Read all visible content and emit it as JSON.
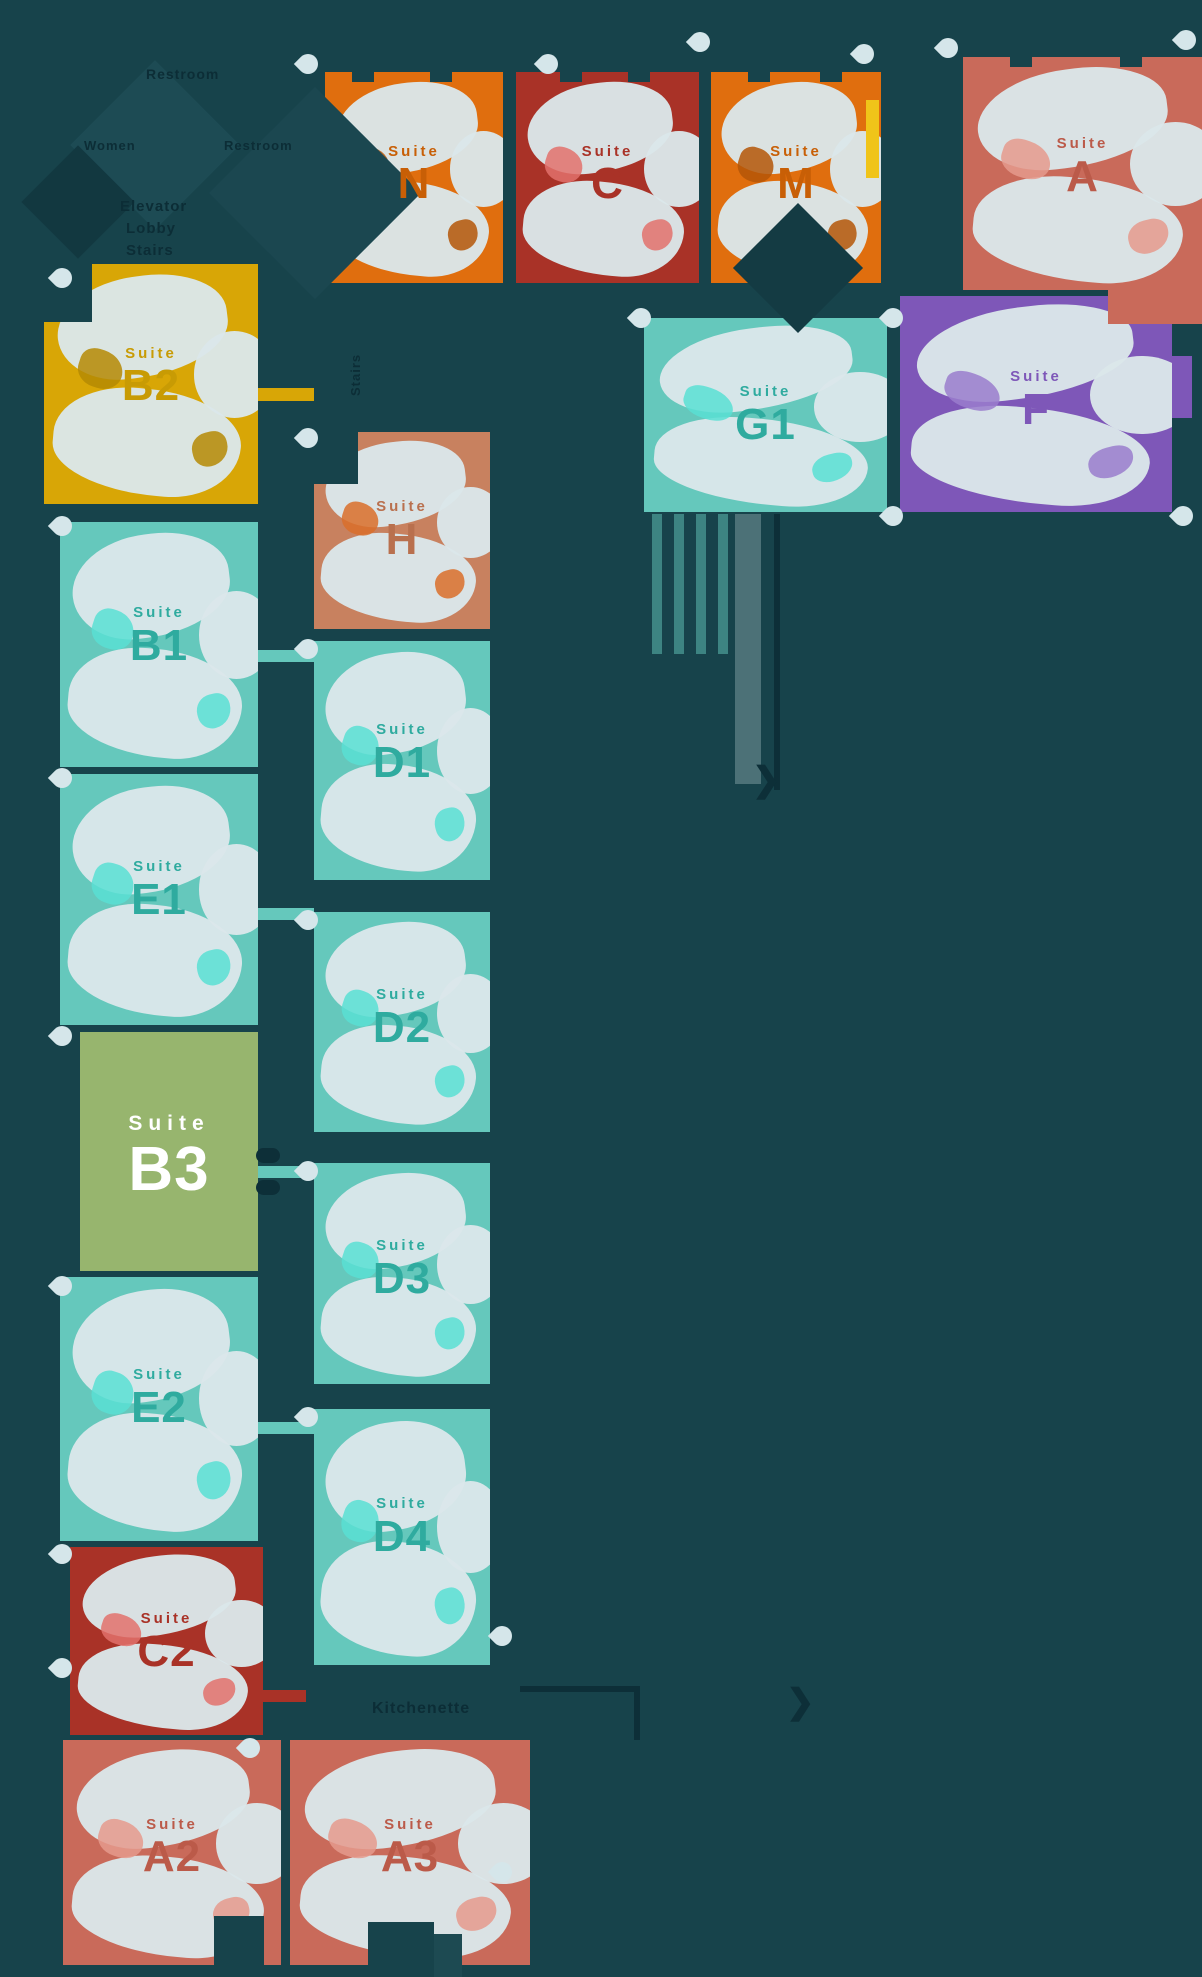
{
  "canvas": {
    "width": 1202,
    "height": 1977,
    "background": "#17434b"
  },
  "palette": {
    "background": "#17434b",
    "orange": "#e06e0e",
    "darkred": "#a93227",
    "salmon": "#c96a5a",
    "yellow": "#d8a606",
    "green": "#97b56e",
    "teal": "#65c8bc",
    "purple": "#7e57b8",
    "tan": "#c8815f",
    "furniture": "#dbe7ea",
    "pin": "#d5e6ea",
    "corridor_text": "#0c2d36",
    "bright_yellow_sliver": "#f0c419"
  },
  "label_accents": {
    "orange": "#c85f06",
    "darkred": "#a93227",
    "salmon": "#bb5a49",
    "yellow": "#c89b04",
    "green": "#ffffff",
    "teal": "#2fab9f",
    "purple": "#7e57b8",
    "tan": "#b9704e"
  },
  "furn_accents": {
    "orange": "#b45607",
    "darkred": "#e2716c",
    "salmon": "#e59a8d",
    "yellow": "#b58a04",
    "green": "#ffffff",
    "teal": "#59dfd4",
    "purple": "#9a7ccc",
    "tan": "#d96f2a"
  },
  "suites": [
    {
      "label": "Suite",
      "code": "N",
      "color": "orange",
      "x": 325,
      "y": 72,
      "w": 178,
      "h": 211,
      "occupied": true,
      "big": false
    },
    {
      "label": "Suite",
      "code": "C",
      "color": "darkred",
      "x": 516,
      "y": 72,
      "w": 183,
      "h": 211,
      "occupied": true,
      "big": false
    },
    {
      "label": "Suite",
      "code": "M",
      "color": "orange",
      "x": 711,
      "y": 72,
      "w": 170,
      "h": 211,
      "occupied": true,
      "big": false
    },
    {
      "label": "Suite",
      "code": "A",
      "color": "salmon",
      "x": 963,
      "y": 57,
      "w": 239,
      "h": 233,
      "occupied": true,
      "big": false
    },
    {
      "label": "Suite",
      "code": "G1",
      "color": "teal",
      "x": 644,
      "y": 318,
      "w": 243,
      "h": 194,
      "occupied": true,
      "big": false
    },
    {
      "label": "Suite",
      "code": "F",
      "color": "purple",
      "x": 900,
      "y": 296,
      "w": 272,
      "h": 216,
      "occupied": true,
      "big": false
    },
    {
      "label": "Suite",
      "code": "B2",
      "color": "yellow",
      "x": 44,
      "y": 264,
      "w": 214,
      "h": 240,
      "occupied": true,
      "big": false
    },
    {
      "label": "Suite",
      "code": "B1",
      "color": "teal",
      "x": 60,
      "y": 522,
      "w": 198,
      "h": 245,
      "occupied": true,
      "big": false
    },
    {
      "label": "Suite",
      "code": "E1",
      "color": "teal",
      "x": 60,
      "y": 774,
      "w": 198,
      "h": 251,
      "occupied": true,
      "big": false
    },
    {
      "label": "Suite",
      "code": "B3",
      "color": "green",
      "x": 80,
      "y": 1032,
      "w": 178,
      "h": 239,
      "occupied": false,
      "big": true
    },
    {
      "label": "Suite",
      "code": "E2",
      "color": "teal",
      "x": 60,
      "y": 1277,
      "w": 198,
      "h": 264,
      "occupied": true,
      "big": false
    },
    {
      "label": "Suite",
      "code": "C2",
      "color": "darkred",
      "x": 70,
      "y": 1547,
      "w": 193,
      "h": 188,
      "occupied": true,
      "big": false
    },
    {
      "label": "Suite",
      "code": "A2",
      "color": "salmon",
      "x": 63,
      "y": 1740,
      "w": 218,
      "h": 225,
      "occupied": true,
      "big": false
    },
    {
      "label": "Suite",
      "code": "A3",
      "color": "salmon",
      "x": 290,
      "y": 1740,
      "w": 240,
      "h": 225,
      "occupied": true,
      "big": false
    },
    {
      "label": "Suite",
      "code": "H",
      "color": "tan",
      "x": 314,
      "y": 432,
      "w": 176,
      "h": 197,
      "occupied": true,
      "big": false
    },
    {
      "label": "Suite",
      "code": "D1",
      "color": "teal",
      "x": 314,
      "y": 641,
      "w": 176,
      "h": 239,
      "occupied": true,
      "big": false
    },
    {
      "label": "Suite",
      "code": "D2",
      "color": "teal",
      "x": 314,
      "y": 912,
      "w": 176,
      "h": 220,
      "occupied": true,
      "big": false
    },
    {
      "label": "Suite",
      "code": "D3",
      "color": "teal",
      "x": 314,
      "y": 1163,
      "w": 176,
      "h": 221,
      "occupied": true,
      "big": false
    },
    {
      "label": "Suite",
      "code": "D4",
      "color": "teal",
      "x": 314,
      "y": 1409,
      "w": 176,
      "h": 256,
      "occupied": true,
      "big": false
    }
  ],
  "corridor_labels": [
    {
      "text": "Restroom",
      "x": 146,
      "y": 66,
      "size": 14,
      "rotate": 0
    },
    {
      "text": "Women",
      "x": 84,
      "y": 138,
      "size": 13,
      "rotate": 0
    },
    {
      "text": "Restroom",
      "x": 224,
      "y": 138,
      "size": 13,
      "rotate": 0
    },
    {
      "text": "Elevator",
      "x": 120,
      "y": 198,
      "size": 15,
      "rotate": 0
    },
    {
      "text": "Lobby",
      "x": 126,
      "y": 220,
      "size": 15,
      "rotate": 0
    },
    {
      "text": "Stairs",
      "x": 126,
      "y": 242,
      "size": 15,
      "rotate": 0
    },
    {
      "text": "Stairs",
      "x": 348,
      "y": 396,
      "size": 13,
      "rotate": -90
    },
    {
      "text": "Kitchenette",
      "x": 372,
      "y": 1700,
      "size": 16,
      "rotate": 0
    }
  ],
  "pins": [
    {
      "x": 62,
      "y": 278
    },
    {
      "x": 308,
      "y": 64
    },
    {
      "x": 548,
      "y": 64
    },
    {
      "x": 700,
      "y": 42
    },
    {
      "x": 864,
      "y": 54
    },
    {
      "x": 948,
      "y": 48
    },
    {
      "x": 1186,
      "y": 40
    },
    {
      "x": 641,
      "y": 318
    },
    {
      "x": 893,
      "y": 318
    },
    {
      "x": 893,
      "y": 516
    },
    {
      "x": 1183,
      "y": 516
    },
    {
      "x": 62,
      "y": 526
    },
    {
      "x": 62,
      "y": 778
    },
    {
      "x": 62,
      "y": 1036
    },
    {
      "x": 62,
      "y": 1286
    },
    {
      "x": 62,
      "y": 1554
    },
    {
      "x": 62,
      "y": 1668
    },
    {
      "x": 250,
      "y": 1748
    },
    {
      "x": 308,
      "y": 438
    },
    {
      "x": 308,
      "y": 649
    },
    {
      "x": 308,
      "y": 920
    },
    {
      "x": 308,
      "y": 1171
    },
    {
      "x": 308,
      "y": 1417
    },
    {
      "x": 502,
      "y": 1636
    },
    {
      "x": 502,
      "y": 1872
    }
  ],
  "icons": [
    {
      "name": "chevron-right-icon",
      "glyph": "❯",
      "x": 752,
      "y": 760
    },
    {
      "name": "chevron-right-icon",
      "glyph": "❯",
      "x": 786,
      "y": 1682
    }
  ]
}
